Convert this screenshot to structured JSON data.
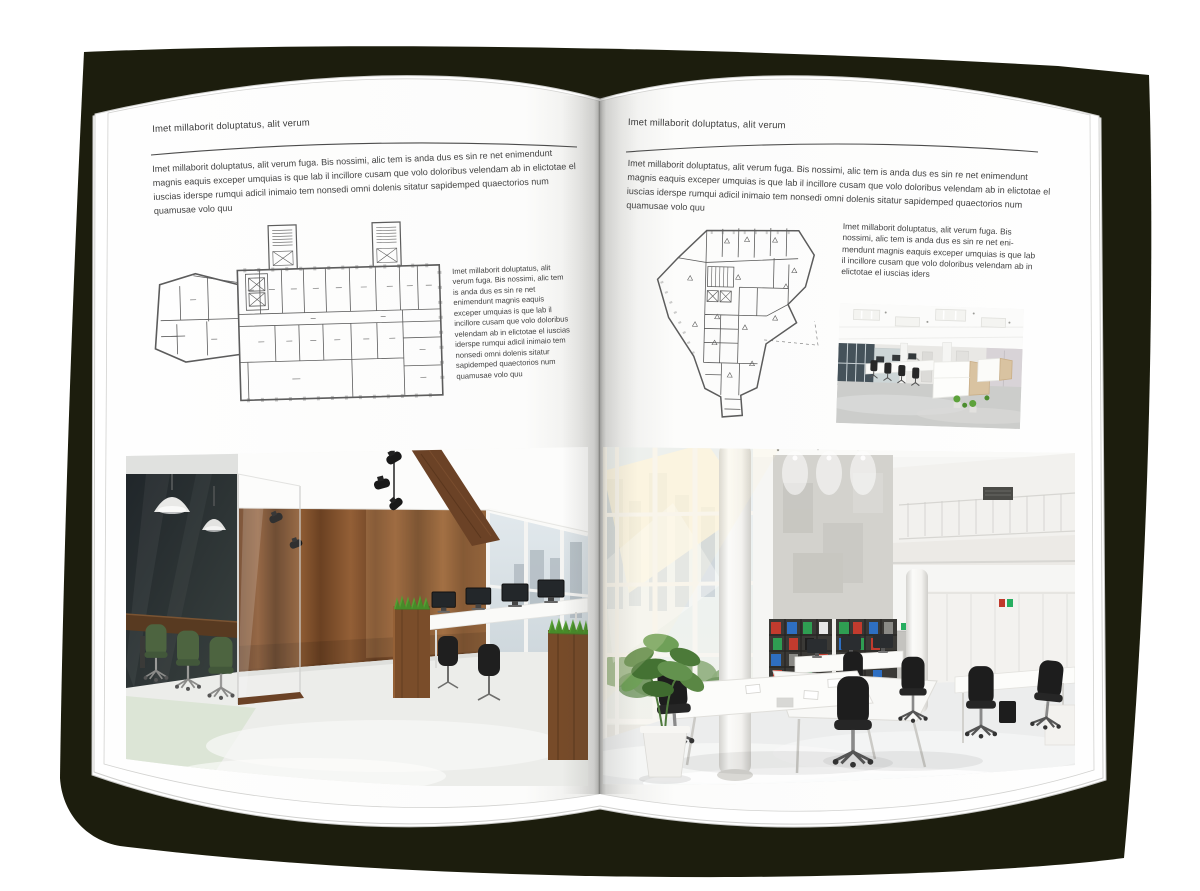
{
  "book": {
    "type": "open-magazine-mockup",
    "colors": {
      "backdrop": "#1c1d0d",
      "page": "#ffffff",
      "text": "#424242",
      "rule": "#4c4c4c",
      "plan_line": "#5c5c5c"
    }
  },
  "left_page": {
    "kicker": "Imet millaborit doluptatus, alit verum",
    "intro": "Imet millaborit doluptatus, alit verum fuga. Bis nossimi, alic tem is anda dus es sin re net enimendunt magnis eaquis exceper umquias is que lab il incillore cusam que volo doloribus velendam ab in elictotae el iuscias iderspe rumqui adicil inimaio tem nonsedi omni dolenis sitatur sapidemped quaectorios num quamusae volo quu",
    "sidebar": "Imet millaborit doluptatus, alit verum fuga. Bis nossimi, alic tem is anda dus es sin re net enimendunt magnis eaquis exceper umquias is que lab il incillore cusam que volo doloribus velendam ab in elictotae el iuscias iderspe rumqui adicil inimaio tem nonsedi omni dolenis sitatur sapidemped quaectorios num quamusae volo quu",
    "figures": [
      "rectangular-building-floor-plan",
      "wood-and-glass-office-interior-photo"
    ]
  },
  "right_page": {
    "kicker": "Imet millaborit doluptatus, alit verum",
    "intro": "Imet millaborit doluptatus, alit verum fuga. Bis nossimi, alic tem is anda dus es sin re net enimendunt magnis eaquis exceper umquias is que lab il incillore cusam que volo doloribus velendam ab in elictotae el iuscias iderspe rumqui adicil inimaio tem nonsedi omni dolenis sitatur sapidemped quaectorios num quamusae volo quu",
    "sidebar": "Imet millaborit doluptatus, alit verum fuga. Bis nossimi, alic tem is anda dus es sin re net eni-mendunt magnis eaquis exceper umquias is que lab il incillore cusam que volo doloribus velendam ab in elictotae el iuscias iders",
    "figures": [
      "irregular-building-floor-plan",
      "white-open-office-photo",
      "atrium-office-interior-photo"
    ]
  }
}
